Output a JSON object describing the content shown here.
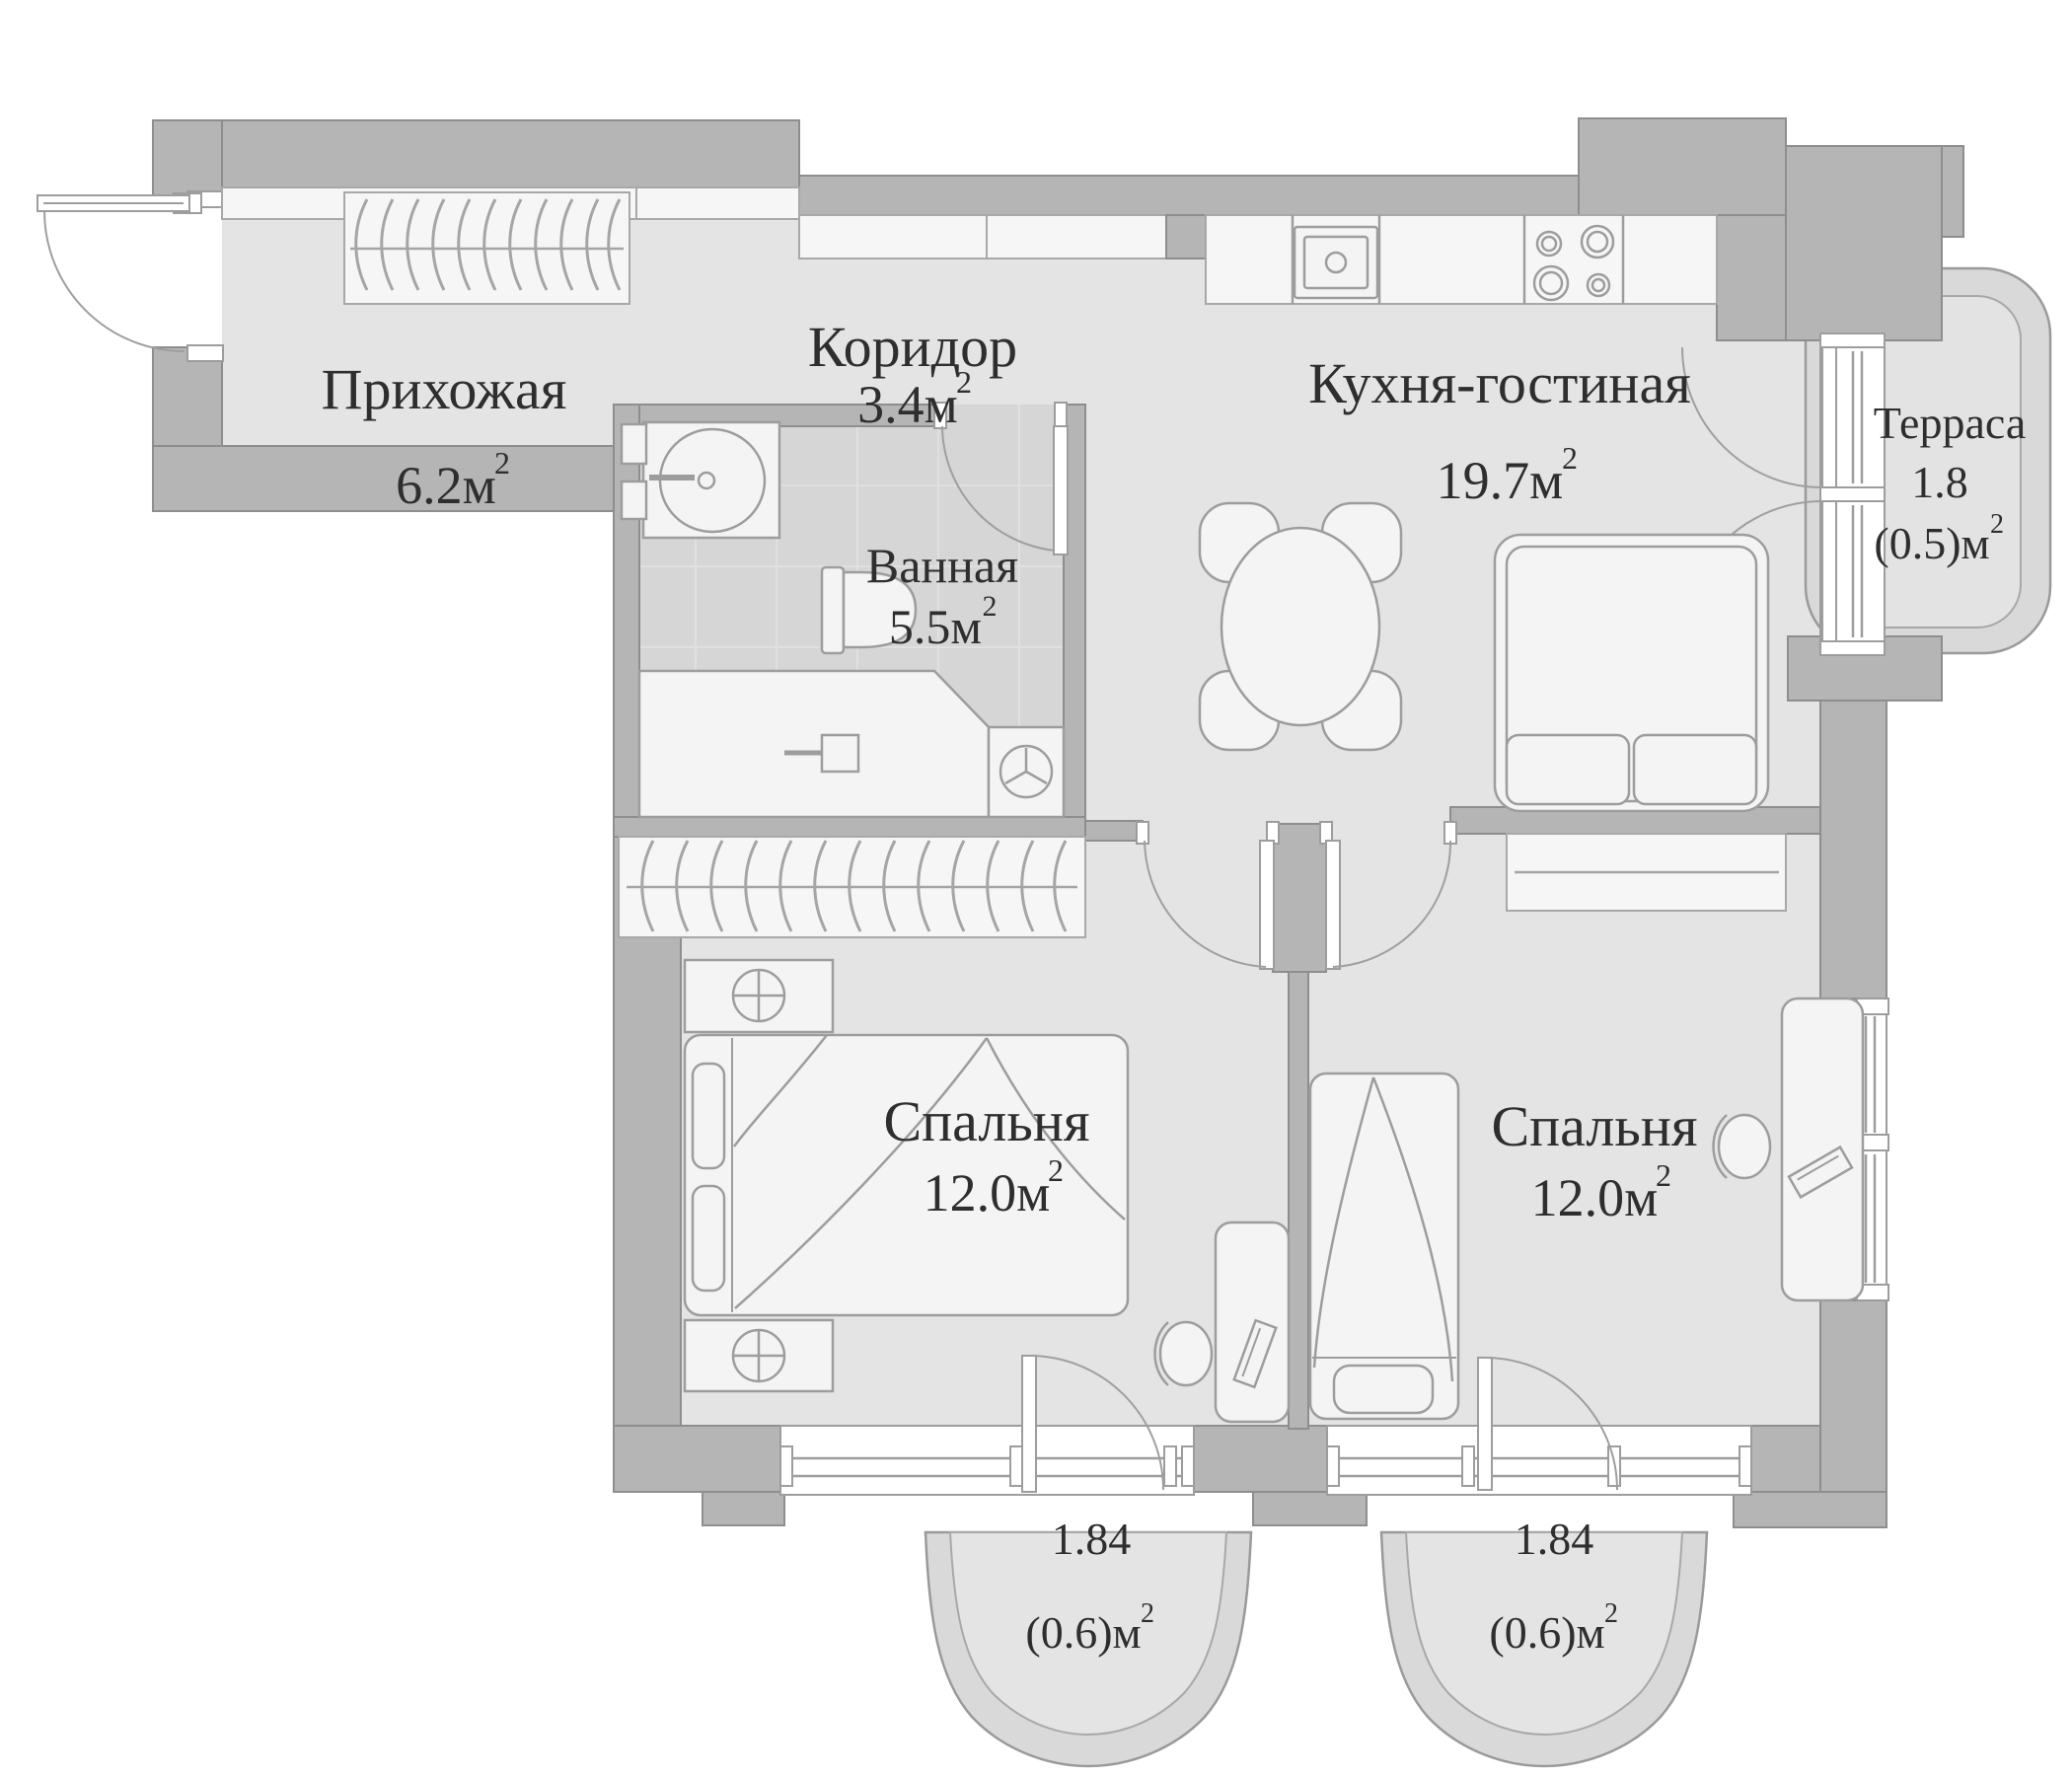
{
  "document": {
    "type": "apartment-floor-plan",
    "language": "ru"
  },
  "palette": {
    "background": "#ffffff",
    "wall_fill": "#b5b5b5",
    "wall_stroke": "#8e8e8e",
    "floor_fill": "#e4e4e4",
    "bathroom_floor_fill": "#d6d6d6",
    "tile_line": "#e0e0e0",
    "furniture_fill": "#f4f4f4",
    "furniture_stroke": "#9d9d9d",
    "balcony_shell_fill": "#d9d9d9",
    "text_color": "#2e2e2e"
  },
  "units": {
    "sup": "2"
  },
  "rooms": [
    {
      "id": "hallway",
      "name": "Прихожая",
      "area_label": "6.2м"
    },
    {
      "id": "corridor",
      "name": "Коридор",
      "area_label": "3.4м"
    },
    {
      "id": "kitchen_living",
      "name": "Кухня-гостиная",
      "area_label": "19.7м"
    },
    {
      "id": "terrace",
      "name": "Терраса",
      "area_value": "1.8",
      "area_secondary": "(0.5)м"
    },
    {
      "id": "bathroom",
      "name": "Ванная",
      "area_label": "5.5м"
    },
    {
      "id": "bedroom_1",
      "name": "Спальня",
      "area_label": "12.0м"
    },
    {
      "id": "bedroom_2",
      "name": "Спальня",
      "area_label": "12.0м"
    },
    {
      "id": "balcony_1",
      "area_value": "1.84",
      "area_secondary": "(0.6)м"
    },
    {
      "id": "balcony_2",
      "area_value": "1.84",
      "area_secondary": "(0.6)м"
    }
  ]
}
